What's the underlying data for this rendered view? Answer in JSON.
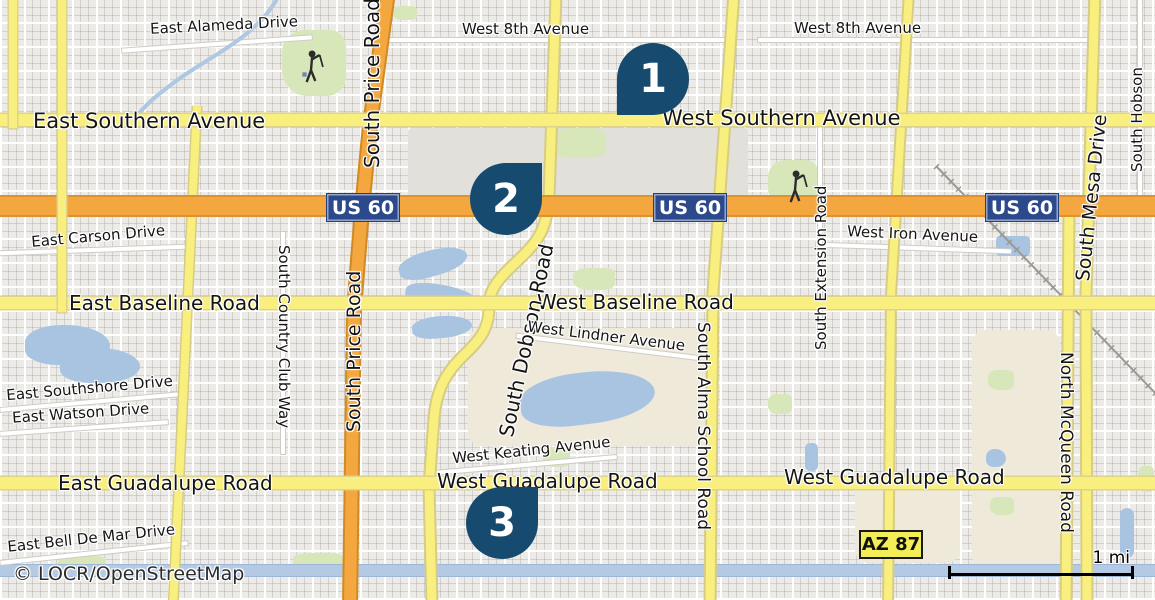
{
  "map": {
    "attribution": "© LOCR/OpenStreetMap",
    "scale_label": "1 mi",
    "markers": [
      {
        "label": "1"
      },
      {
        "label": "2"
      },
      {
        "label": "3"
      }
    ],
    "shields": {
      "us60": "US 60",
      "az87": "AZ 87"
    },
    "streets": {
      "east_alameda_drive": "East Alameda Drive",
      "west_8th_avenue": "West 8th Avenue",
      "south_price_road": "South Price Road",
      "east_southern_avenue": "East Southern Avenue",
      "west_southern_avenue": "West Southern Avenue",
      "east_carson_drive": "East Carson Drive",
      "west_iron_avenue": "West Iron Avenue",
      "south_extension_road": "South Extension Road",
      "east_baseline_road": "East Baseline Road",
      "west_baseline_road": "West Baseline Road",
      "south_country_club_way": "South Country Club Way",
      "south_dobson_road": "South Dobson Road",
      "west_lindner_avenue": "West Lindner Avenue",
      "south_alma_school_road": "South Alma School Road",
      "east_southshore_drive": "East Southshore Drive",
      "east_watson_drive": "East Watson Drive",
      "west_keating_avenue": "West Keating Avenue",
      "east_guadalupe_road": "East Guadalupe Road",
      "west_guadalupe_road": "West Guadalupe Road",
      "east_bell_de_mar_drive": "East Bell De Mar Drive",
      "south_mesa_drive": "South Mesa Drive",
      "south_hobson": "South Hobson",
      "north_mcqueen_road": "North McQueen Road"
    },
    "colors": {
      "marker_blue": "#164b6f",
      "us_shield_bg": "#2c4a8b",
      "az_shield_bg": "#f3ee58",
      "road_yellow": "#f8ef7f",
      "highway_orange": "#f3a73e",
      "water_blue": "#a9c4e1",
      "park_green": "#d8e7ba"
    }
  }
}
